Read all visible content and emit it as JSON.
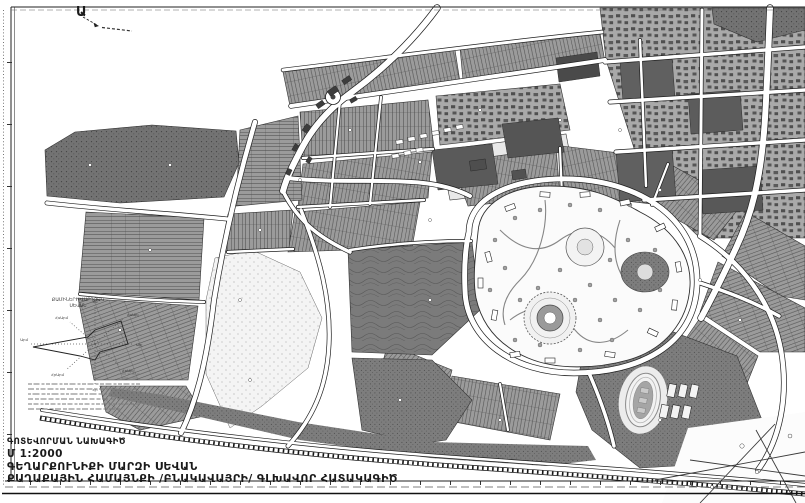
{
  "map": {
    "kind": "zoning-map-scan",
    "region_marker": "Ա",
    "title_block": {
      "project_type": "ԳՈՏԵՎՈՐՄԱՆ ՆԱԽԱԳԻԾ",
      "scale": "Մ 1:2000",
      "location": "ԳԵՂԱՐՔՈՒՆԻՔԻ ՄԱՐԶԻ ՍԵՎԱՆ",
      "document": "ՔԱՂԱՔԱՅԻՆ ՀԱՄԱՅՆՔԻ /ԲՆԱԿԱՎԱՅՐԻ/ ԳԼԽԱՎՈՐ ՀԱՏԱԿԱԳԻԾ"
    },
    "wind_rose": {
      "title_line1": "ՔԱՄԻՆԵՐԻ ՎԱՐԴՅԱԿ",
      "title_line2": "ՍԵՎԱՆ",
      "directions": {
        "n": "Հս",
        "ne": "ՀսԱրլ",
        "e": "Արլ",
        "se": "ՀրԱրլ",
        "s": "Հր",
        "sw": "ՀրԱրմ",
        "w": "Արմ",
        "nw": "ՀսԱրմ"
      }
    },
    "colors": {
      "ink": "#1c1c1c",
      "parcel_gray": "#9b9b9b",
      "forest_gray": "#737373",
      "dark_zone_gray": "#7d7d7d",
      "urban_gray": "#a9a9a9",
      "park_white": "#fbfbfb",
      "street_white": "#ffffff",
      "building_dark": "#3d3d3d"
    }
  }
}
